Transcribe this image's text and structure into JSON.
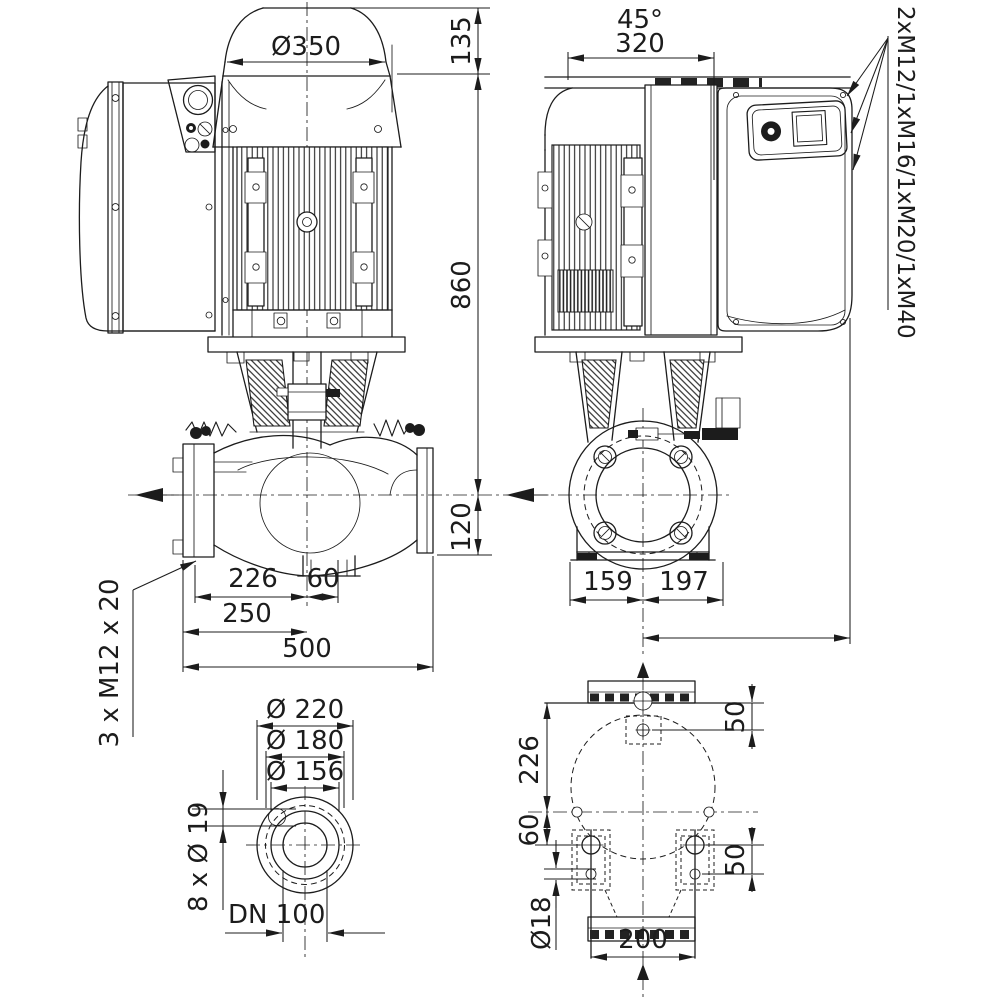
{
  "drawing": {
    "type": "pump-dimension-drawing",
    "side_view": {
      "label_fan_diameter": "Ø350",
      "label_top_height": "135",
      "label_total_height": "860",
      "label_axis_height": "120",
      "label_suction_to_axis": "226",
      "label_axis_offset": "60",
      "label_half_port": "250",
      "label_port_length": "500",
      "label_anchor_bolts": "3 x M12 x 20"
    },
    "rotated_view": {
      "label_angle": "45°",
      "label_width": "320",
      "label_cable_glands": "2xM12/1xM16/1xM20/1xM40",
      "label_foot_left": "159",
      "label_foot_right": "197"
    },
    "flange_view": {
      "label_outer_diameter": "Ø 220",
      "label_bolt_circle": "Ø 180",
      "label_raised_face": "Ø 156",
      "label_bolt_holes": "8 x Ø 19",
      "label_nominal_bore": "DN 100"
    },
    "base_view": {
      "label_top_bolt_offset": "50",
      "label_flange_to_axis": "226",
      "label_axis_to_foot": "60",
      "label_foot_bolt_offset": "50",
      "label_hole_diameter": "Ø18",
      "label_bolt_spacing": "200"
    },
    "colors": {
      "line": "#1c1c1c",
      "background": "#ffffff"
    }
  }
}
